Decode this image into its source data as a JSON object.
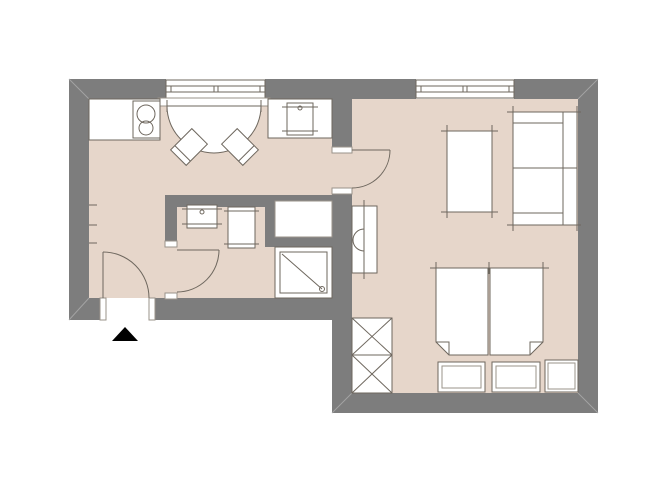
{
  "meta": {
    "kind": "apartment-floor-plan",
    "rooms": [
      "kitchen-dining",
      "hallway",
      "bathroom",
      "living-bedroom"
    ]
  },
  "canvas": {
    "w": 670,
    "h": 503,
    "background": "#ffffff"
  },
  "colors": {
    "wall": "#7d7d7d",
    "floor": "#e6d6ca",
    "line": "#6e675e",
    "soft": "#9a938a",
    "miter": "#a3a3a3",
    "white": "#ffffff",
    "marker": "#000000"
  },
  "shapes": [
    {
      "name": "floor-kitchen-hall",
      "kind": "rect",
      "x": 89,
      "y": 99,
      "w": 243,
      "h": 199,
      "fill": "$floor"
    },
    {
      "name": "floor-living-room",
      "kind": "rect",
      "x": 352,
      "y": 99,
      "w": 226,
      "h": 294,
      "fill": "$floor"
    },
    {
      "name": "floor-living-door-opening",
      "kind": "rect",
      "x": 332,
      "y": 153,
      "w": 20,
      "h": 35,
      "fill": "$floor"
    },
    {
      "name": "floor-bath-door-opening",
      "kind": "rect",
      "x": 165,
      "y": 247,
      "w": 12,
      "h": 46,
      "fill": "$floor"
    },
    {
      "name": "wall-top-left",
      "kind": "rect",
      "x": 69,
      "y": 79,
      "w": 97,
      "h": 20,
      "fill": "$wall"
    },
    {
      "name": "wall-top-mid",
      "kind": "rect",
      "x": 265,
      "y": 79,
      "w": 151,
      "h": 20,
      "fill": "$wall"
    },
    {
      "name": "wall-top-right",
      "kind": "rect",
      "x": 514,
      "y": 79,
      "w": 84,
      "h": 20,
      "fill": "$wall"
    },
    {
      "name": "wall-left",
      "kind": "rect",
      "x": 69,
      "y": 79,
      "w": 20,
      "h": 241,
      "fill": "$wall"
    },
    {
      "name": "wall-entry-left",
      "kind": "rect",
      "x": 69,
      "y": 298,
      "w": 31,
      "h": 22,
      "fill": "$wall"
    },
    {
      "name": "wall-entry-right",
      "kind": "rect",
      "x": 155,
      "y": 298,
      "w": 197,
      "h": 22,
      "fill": "$wall"
    },
    {
      "name": "wall-right",
      "kind": "rect",
      "x": 578,
      "y": 79,
      "w": 20,
      "h": 334,
      "fill": "$wall"
    },
    {
      "name": "wall-bottom",
      "kind": "rect",
      "x": 332,
      "y": 393,
      "w": 266,
      "h": 20,
      "fill": "$wall"
    },
    {
      "name": "wall-living-left-upper",
      "kind": "rect",
      "x": 332,
      "y": 99,
      "w": 20,
      "h": 48,
      "fill": "$wall"
    },
    {
      "name": "wall-living-left-lower",
      "kind": "rect",
      "x": 332,
      "y": 194,
      "w": 20,
      "h": 199,
      "fill": "$wall"
    },
    {
      "name": "wall-bath-top",
      "kind": "rect",
      "x": 165,
      "y": 195,
      "w": 100,
      "h": 12,
      "fill": "$wall"
    },
    {
      "name": "wall-bath-top-thin",
      "kind": "rect",
      "x": 265,
      "y": 195,
      "w": 80,
      "h": 6,
      "fill": "$wall"
    },
    {
      "name": "wall-bath-left",
      "kind": "rect",
      "x": 165,
      "y": 207,
      "w": 12,
      "h": 34,
      "fill": "$wall"
    },
    {
      "name": "wall-niche-left",
      "kind": "rect",
      "x": 265,
      "y": 201,
      "w": 10,
      "h": 46,
      "fill": "$wall"
    },
    {
      "name": "wall-niche-bottom",
      "kind": "rect",
      "x": 275,
      "y": 237,
      "w": 57,
      "h": 10,
      "fill": "$wall"
    },
    {
      "name": "corner-line-top-left",
      "kind": "line",
      "x1": 69,
      "y1": 79,
      "x2": 89,
      "y2": 99,
      "stroke": "$miter"
    },
    {
      "name": "corner-line-top-right",
      "kind": "line",
      "x1": 598,
      "y1": 79,
      "x2": 578,
      "y2": 99,
      "stroke": "$miter"
    },
    {
      "name": "corner-line-bottom-right",
      "kind": "line",
      "x1": 598,
      "y1": 413,
      "x2": 578,
      "y2": 393,
      "stroke": "$miter"
    },
    {
      "name": "corner-line-bottom-left",
      "kind": "line",
      "x1": 69,
      "y1": 320,
      "x2": 89,
      "y2": 298,
      "stroke": "$miter"
    },
    {
      "name": "corner-line-bottom-mid",
      "kind": "line",
      "x1": 332,
      "y1": 413,
      "x2": 352,
      "y2": 393,
      "stroke": "$miter"
    },
    {
      "name": "kitchen-window-frame",
      "kind": "rect",
      "x": 166,
      "y": 80,
      "w": 99,
      "h": 18,
      "fill": "$white",
      "stroke": "$line"
    },
    {
      "name": "kitchen-window-glass-outer",
      "kind": "line",
      "x1": 166,
      "y1": 86,
      "x2": 265,
      "y2": 86
    },
    {
      "name": "kitchen-window-glass-inner",
      "kind": "line",
      "x1": 166,
      "y1": 92,
      "x2": 265,
      "y2": 92
    },
    {
      "name": "kitchen-window-tick-1",
      "kind": "line",
      "x1": 171,
      "y1": 86,
      "x2": 171,
      "y2": 92
    },
    {
      "name": "kitchen-window-tick-2",
      "kind": "line",
      "x1": 214,
      "y1": 86,
      "x2": 214,
      "y2": 92
    },
    {
      "name": "kitchen-window-tick-3",
      "kind": "line",
      "x1": 218,
      "y1": 86,
      "x2": 218,
      "y2": 92
    },
    {
      "name": "kitchen-window-tick-4",
      "kind": "line",
      "x1": 260,
      "y1": 86,
      "x2": 260,
      "y2": 92
    },
    {
      "name": "kitchen-window-sill",
      "kind": "rect",
      "x": 158,
      "y": 98,
      "w": 112,
      "h": 8,
      "fill": "$white",
      "stroke": "$soft"
    },
    {
      "name": "living-window-frame",
      "kind": "rect",
      "x": 416,
      "y": 80,
      "w": 98,
      "h": 18,
      "fill": "$white",
      "stroke": "$line"
    },
    {
      "name": "living-window-glass-outer",
      "kind": "line",
      "x1": 416,
      "y1": 86,
      "x2": 514,
      "y2": 86
    },
    {
      "name": "living-window-glass-inner",
      "kind": "line",
      "x1": 416,
      "y1": 92,
      "x2": 514,
      "y2": 92
    },
    {
      "name": "living-window-tick-1",
      "kind": "line",
      "x1": 421,
      "y1": 86,
      "x2": 421,
      "y2": 92
    },
    {
      "name": "living-window-tick-2",
      "kind": "line",
      "x1": 463,
      "y1": 86,
      "x2": 463,
      "y2": 92
    },
    {
      "name": "living-window-tick-3",
      "kind": "line",
      "x1": 467,
      "y1": 86,
      "x2": 467,
      "y2": 92
    },
    {
      "name": "living-window-tick-4",
      "kind": "line",
      "x1": 509,
      "y1": 86,
      "x2": 509,
      "y2": 92
    },
    {
      "name": "kitchen-counter",
      "kind": "rect",
      "x": 89,
      "y": 99,
      "w": 71,
      "h": 41,
      "fill": "$white",
      "stroke": "$line"
    },
    {
      "name": "cooktop",
      "kind": "rect",
      "x": 133,
      "y": 101,
      "w": 27,
      "h": 37,
      "fill": "$white",
      "stroke": "$line"
    },
    {
      "name": "cooktop-burner-large",
      "kind": "circle",
      "cx": 146,
      "cy": 114,
      "r": 9,
      "stroke": "$line"
    },
    {
      "name": "cooktop-burner-small",
      "kind": "circle",
      "cx": 146,
      "cy": 128,
      "r": 7,
      "stroke": "$line"
    },
    {
      "name": "dining-table",
      "kind": "path",
      "d": "M 167,106 A 47,47 0 0 0 261,106 Z",
      "fill": "$white",
      "stroke": "$line"
    },
    {
      "name": "dining-table-tick-left",
      "kind": "line",
      "x1": 167,
      "y1": 100,
      "x2": 167,
      "y2": 112
    },
    {
      "name": "dining-table-tick-right",
      "kind": "line",
      "x1": 261,
      "y1": 100,
      "x2": 261,
      "y2": 112
    },
    {
      "name": "chair-left",
      "kind": "rect",
      "x": 178,
      "y": 132,
      "w": 22,
      "h": 30,
      "fill": "$white",
      "stroke": "$line",
      "tf": "rotate(45 189 147)"
    },
    {
      "name": "chair-left-backrest",
      "kind": "line",
      "x1": 178,
      "y1": 156,
      "x2": 200,
      "y2": 156,
      "tf": "rotate(45 189 147)"
    },
    {
      "name": "chair-right",
      "kind": "rect",
      "x": 229,
      "y": 132,
      "w": 22,
      "h": 30,
      "fill": "$white",
      "stroke": "$line",
      "tf": "rotate(-45 240 147)"
    },
    {
      "name": "chair-right-backrest",
      "kind": "line",
      "x1": 229,
      "y1": 156,
      "x2": 251,
      "y2": 156,
      "tf": "rotate(-45 240 147)"
    },
    {
      "name": "kitchen-counter-right",
      "kind": "rect",
      "x": 268,
      "y": 99,
      "w": 64,
      "h": 39,
      "fill": "$white",
      "stroke": "$line"
    },
    {
      "name": "kitchen-sink",
      "kind": "rect",
      "x": 287,
      "y": 103,
      "w": 26,
      "h": 32,
      "fill": "$white",
      "stroke": "$line"
    },
    {
      "name": "kitchen-sink-tick-top",
      "kind": "line",
      "x1": 282,
      "y1": 107,
      "x2": 318,
      "y2": 107
    },
    {
      "name": "kitchen-sink-tick-bottom",
      "kind": "line",
      "x1": 282,
      "y1": 131,
      "x2": 318,
      "y2": 131
    },
    {
      "name": "kitchen-sink-tap",
      "kind": "circle",
      "cx": 300,
      "cy": 108,
      "r": 2,
      "stroke": "$line"
    },
    {
      "name": "wall-hook-tick-1",
      "kind": "line",
      "x1": 89,
      "y1": 205,
      "x2": 97,
      "y2": 205
    },
    {
      "name": "wall-hook-tick-2",
      "kind": "line",
      "x1": 89,
      "y1": 225,
      "x2": 97,
      "y2": 225
    },
    {
      "name": "wall-hook-tick-3",
      "kind": "line",
      "x1": 89,
      "y1": 243,
      "x2": 97,
      "y2": 243
    },
    {
      "name": "entrance-door-jamb-left",
      "kind": "rect",
      "x": 100,
      "y": 298,
      "w": 6,
      "h": 22,
      "fill": "$white",
      "stroke": "$soft"
    },
    {
      "name": "entrance-door-jamb-right",
      "kind": "rect",
      "x": 149,
      "y": 298,
      "w": 6,
      "h": 22,
      "fill": "$white",
      "stroke": "$soft"
    },
    {
      "name": "entrance-door-leaf",
      "kind": "line",
      "x1": 103,
      "y1": 252,
      "x2": 103,
      "y2": 298
    },
    {
      "name": "entrance-door-swing",
      "kind": "path",
      "d": "M 103,252 A 46,46 0 0 1 149,298",
      "stroke": "$line"
    },
    {
      "name": "entrance-marker",
      "kind": "polygon",
      "pts": "112,341 138,341 125,327",
      "fill": "$marker"
    },
    {
      "name": "bathroom-door-jamb-top",
      "kind": "rect",
      "x": 165,
      "y": 241,
      "w": 12,
      "h": 6,
      "fill": "$white",
      "stroke": "$soft"
    },
    {
      "name": "bathroom-door-jamb-bottom",
      "kind": "rect",
      "x": 165,
      "y": 293,
      "w": 12,
      "h": 6,
      "fill": "$white",
      "stroke": "$soft"
    },
    {
      "name": "bathroom-door-leaf",
      "kind": "line",
      "x1": 177,
      "y1": 250,
      "x2": 219,
      "y2": 250
    },
    {
      "name": "bathroom-door-swing",
      "kind": "path",
      "d": "M 219,250 A 42,42 0 0 1 177,292",
      "stroke": "$line"
    },
    {
      "name": "living-door-jamb-top",
      "kind": "rect",
      "x": 332,
      "y": 147,
      "w": 20,
      "h": 6,
      "fill": "$white",
      "stroke": "$soft"
    },
    {
      "name": "living-door-jamb-bottom",
      "kind": "rect",
      "x": 332,
      "y": 188,
      "w": 20,
      "h": 6,
      "fill": "$white",
      "stroke": "$soft"
    },
    {
      "name": "living-door-leaf",
      "kind": "line",
      "x1": 352,
      "y1": 150,
      "x2": 390,
      "y2": 150
    },
    {
      "name": "living-door-swing",
      "kind": "path",
      "d": "M 390,150 A 38,38 0 0 1 352,188",
      "stroke": "$line"
    },
    {
      "name": "washbasin",
      "kind": "rect",
      "x": 187,
      "y": 205,
      "w": 30,
      "h": 23,
      "fill": "$white",
      "stroke": "$line"
    },
    {
      "name": "washbasin-tick-top",
      "kind": "line",
      "x1": 182,
      "y1": 209,
      "x2": 222,
      "y2": 209
    },
    {
      "name": "washbasin-tick-bottom",
      "kind": "line",
      "x1": 182,
      "y1": 224,
      "x2": 222,
      "y2": 224
    },
    {
      "name": "washbasin-tap",
      "kind": "circle",
      "cx": 202,
      "cy": 212,
      "r": 2,
      "stroke": "$line"
    },
    {
      "name": "toilet",
      "kind": "rect",
      "x": 228,
      "y": 207,
      "w": 27,
      "h": 41,
      "fill": "$white",
      "stroke": "$line"
    },
    {
      "name": "toilet-tick-top",
      "kind": "line",
      "x1": 224,
      "y1": 211,
      "x2": 259,
      "y2": 211
    },
    {
      "name": "toilet-tick-bottom",
      "kind": "line",
      "x1": 224,
      "y1": 244,
      "x2": 259,
      "y2": 244
    },
    {
      "name": "utility-niche",
      "kind": "rect",
      "x": 275,
      "y": 201,
      "w": 57,
      "h": 36,
      "fill": "$white",
      "stroke": "$soft"
    },
    {
      "name": "shower",
      "kind": "rect",
      "x": 275,
      "y": 247,
      "w": 57,
      "h": 51,
      "fill": "$white",
      "stroke": "$line"
    },
    {
      "name": "shower-inner",
      "kind": "rect",
      "x": 280,
      "y": 252,
      "w": 47,
      "h": 41,
      "stroke": "$line"
    },
    {
      "name": "shower-diagonal",
      "kind": "line",
      "x1": 282,
      "y1": 254,
      "x2": 322,
      "y2": 289
    },
    {
      "name": "shower-drain",
      "kind": "circle",
      "cx": 322,
      "cy": 289,
      "r": 2.5,
      "stroke": "$line"
    },
    {
      "name": "radiator",
      "kind": "rect",
      "x": 352,
      "y": 206,
      "w": 25,
      "h": 67,
      "fill": "$white",
      "stroke": "$line"
    },
    {
      "name": "radiator-line",
      "kind": "line",
      "x1": 364,
      "y1": 200,
      "x2": 364,
      "y2": 279
    },
    {
      "name": "radiator-valve",
      "kind": "path",
      "d": "M 364,229 A 11,11 0 0 0 364,251",
      "stroke": "$line"
    },
    {
      "name": "living-table",
      "kind": "rect",
      "x": 447,
      "y": 131,
      "w": 45,
      "h": 81,
      "fill": "$white"
    },
    {
      "name": "living-table-edge-top",
      "kind": "line",
      "x1": 441,
      "y1": 131,
      "x2": 498,
      "y2": 131
    },
    {
      "name": "living-table-edge-bottom",
      "kind": "line",
      "x1": 441,
      "y1": 212,
      "x2": 498,
      "y2": 212
    },
    {
      "name": "living-table-edge-left",
      "kind": "line",
      "x1": 447,
      "y1": 125,
      "x2": 447,
      "y2": 218
    },
    {
      "name": "living-table-edge-right",
      "kind": "line",
      "x1": 492,
      "y1": 125,
      "x2": 492,
      "y2": 218
    },
    {
      "name": "sofa",
      "kind": "rect",
      "x": 513,
      "y": 112,
      "w": 64,
      "h": 113,
      "fill": "$white"
    },
    {
      "name": "sofa-edge-top",
      "kind": "line",
      "x1": 507,
      "y1": 112,
      "x2": 581,
      "y2": 112
    },
    {
      "name": "sofa-edge-bottom",
      "kind": "line",
      "x1": 507,
      "y1": 225,
      "x2": 581,
      "y2": 225
    },
    {
      "name": "sofa-edge-left",
      "kind": "line",
      "x1": 513,
      "y1": 106,
      "x2": 513,
      "y2": 231
    },
    {
      "name": "sofa-edge-right",
      "kind": "line",
      "x1": 577,
      "y1": 106,
      "x2": 577,
      "y2": 231
    },
    {
      "name": "sofa-backrest",
      "kind": "line",
      "x1": 563,
      "y1": 112,
      "x2": 563,
      "y2": 225
    },
    {
      "name": "sofa-armrest-top",
      "kind": "line",
      "x1": 513,
      "y1": 123,
      "x2": 563,
      "y2": 123
    },
    {
      "name": "sofa-armrest-bottom",
      "kind": "line",
      "x1": 513,
      "y1": 213,
      "x2": 563,
      "y2": 213
    },
    {
      "name": "sofa-cushion-divider",
      "kind": "line",
      "x1": 513,
      "y1": 168,
      "x2": 577,
      "y2": 168
    },
    {
      "name": "bed-mattress-left",
      "kind": "path",
      "d": "M 436,268 L 488,268 L 488,355 L 449,355 L 436,342 Z",
      "fill": "$white",
      "stroke": "$line"
    },
    {
      "name": "bed-mattress-right",
      "kind": "path",
      "d": "M 490,268 L 543,268 L 543,342 L 530,355 L 490,355 Z",
      "fill": "$white",
      "stroke": "$line"
    },
    {
      "name": "bed-fold-left",
      "kind": "path",
      "d": "M 436,342 L 449,342 L 449,355",
      "stroke": "$line"
    },
    {
      "name": "bed-fold-right",
      "kind": "path",
      "d": "M 543,342 L 530,342 L 530,355",
      "stroke": "$line"
    },
    {
      "name": "bed-head-line",
      "kind": "line",
      "x1": 430,
      "y1": 268,
      "x2": 549,
      "y2": 268
    },
    {
      "name": "bed-tick-left",
      "kind": "line",
      "x1": 436,
      "y1": 262,
      "x2": 436,
      "y2": 274
    },
    {
      "name": "bed-tick-center",
      "kind": "line",
      "x1": 489,
      "y1": 262,
      "x2": 489,
      "y2": 274
    },
    {
      "name": "bed-tick-right",
      "kind": "line",
      "x1": 543,
      "y1": 262,
      "x2": 543,
      "y2": 274
    },
    {
      "name": "bed-bench-left",
      "kind": "rect",
      "x": 438,
      "y": 362,
      "w": 47,
      "h": 30,
      "fill": "$white",
      "stroke": "$line"
    },
    {
      "name": "bed-bench-left-inner",
      "kind": "rect",
      "x": 442,
      "y": 366,
      "w": 39,
      "h": 22,
      "stroke": "$soft"
    },
    {
      "name": "bed-bench-right",
      "kind": "rect",
      "x": 492,
      "y": 362,
      "w": 48,
      "h": 30,
      "fill": "$white",
      "stroke": "$line"
    },
    {
      "name": "bed-bench-right-inner",
      "kind": "rect",
      "x": 496,
      "y": 366,
      "w": 40,
      "h": 22,
      "stroke": "$soft"
    },
    {
      "name": "nightstand",
      "kind": "rect",
      "x": 545,
      "y": 360,
      "w": 33,
      "h": 32,
      "fill": "$white",
      "stroke": "$line"
    },
    {
      "name": "nightstand-inner",
      "kind": "rect",
      "x": 548,
      "y": 363,
      "w": 27,
      "h": 26,
      "stroke": "$soft"
    },
    {
      "name": "wardrobe-upper",
      "kind": "rect",
      "x": 352,
      "y": 318,
      "w": 40,
      "h": 37,
      "fill": "$white",
      "stroke": "$line"
    },
    {
      "name": "wardrobe-upper-diag-1",
      "kind": "line",
      "x1": 352,
      "y1": 318,
      "x2": 392,
      "y2": 355
    },
    {
      "name": "wardrobe-upper-diag-2",
      "kind": "line",
      "x1": 392,
      "y1": 318,
      "x2": 352,
      "y2": 355
    },
    {
      "name": "wardrobe-lower",
      "kind": "rect",
      "x": 352,
      "y": 355,
      "w": 40,
      "h": 38,
      "fill": "$white",
      "stroke": "$line"
    },
    {
      "name": "wardrobe-lower-diag-1",
      "kind": "line",
      "x1": 352,
      "y1": 355,
      "x2": 392,
      "y2": 393
    },
    {
      "name": "wardrobe-lower-diag-2",
      "kind": "line",
      "x1": 392,
      "y1": 355,
      "x2": 352,
      "y2": 393
    }
  ]
}
